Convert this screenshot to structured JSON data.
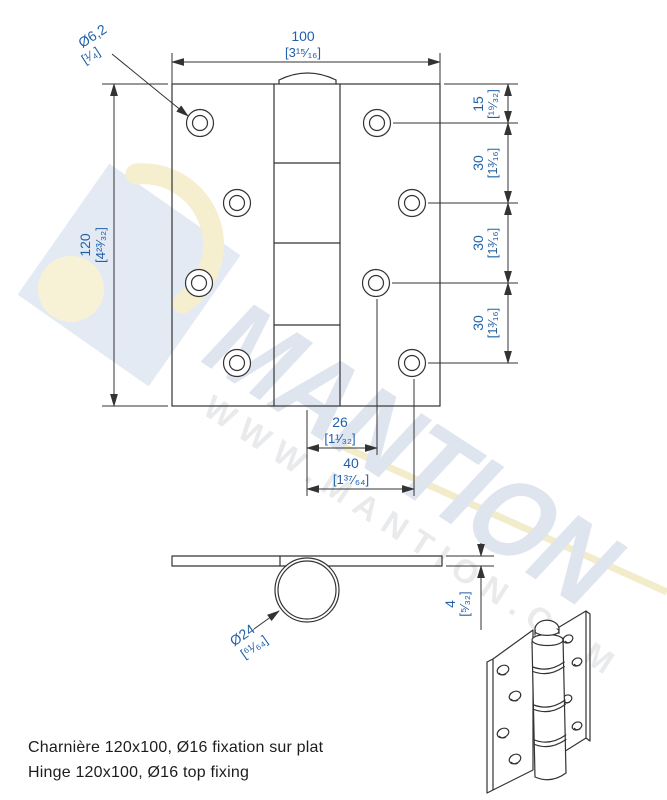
{
  "watermark": {
    "brand": "MANTION",
    "url": "WWW.MANTION.COM"
  },
  "front_view": {
    "hole_dia": {
      "value": "Ø6,2",
      "imperial": "[¹⁄₄]"
    },
    "width": {
      "value": "100",
      "imperial": "[3¹⁵⁄₁₆]"
    },
    "height": {
      "value": "120",
      "imperial": "[4²³⁄₃₂]"
    },
    "right_dims": [
      {
        "value": "15",
        "imperial": "[¹⁹⁄₃₂]"
      },
      {
        "value": "30",
        "imperial": "[1³⁄₁₆]"
      },
      {
        "value": "30",
        "imperial": "[1³⁄₁₆]"
      },
      {
        "value": "30",
        "imperial": "[1³⁄₁₆]"
      }
    ],
    "offset_dims": [
      {
        "value": "26",
        "imperial": "[1¹⁄₃₂]"
      },
      {
        "value": "40",
        "imperial": "[1³⁷⁄₆₄]"
      }
    ]
  },
  "side_view": {
    "knuckle_dia": {
      "value": "Ø24",
      "imperial": "[⁶¹⁄₆₄]"
    },
    "thickness": {
      "value": "4",
      "imperial": "[⁵⁄₃₂]"
    }
  },
  "captions": {
    "french": "Charnière 120x100, Ø16 fixation sur plat",
    "english": "Hinge 120x100, Ø16 top fixing"
  },
  "colors": {
    "dimension_text": "#2160a7",
    "drawing_line": "#333333",
    "watermark_brand": "#dfe5ef",
    "watermark_url": "#e9eaec",
    "logo_blue": "#e3eaf4",
    "logo_yellow": "#f5efcf"
  }
}
